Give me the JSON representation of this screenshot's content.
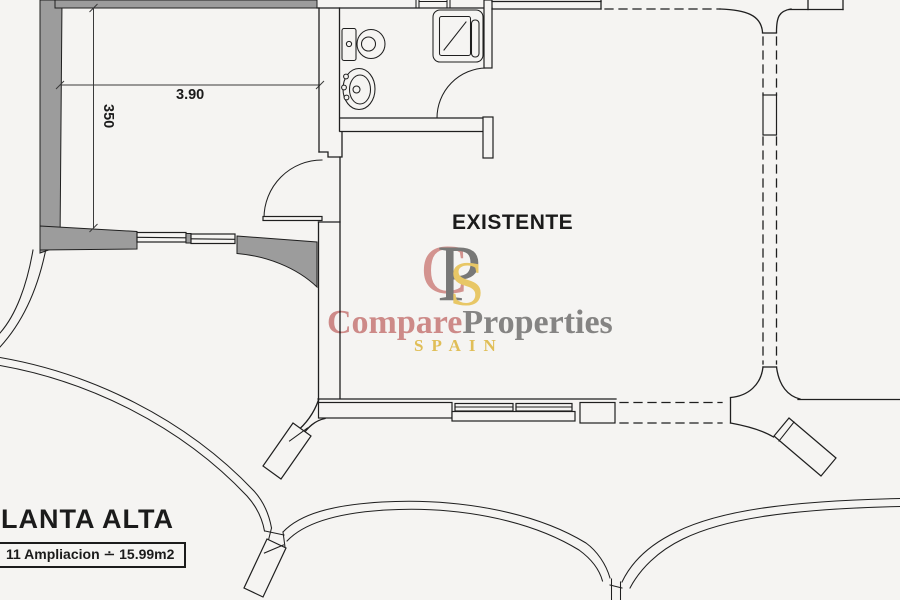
{
  "page": {
    "background": "#f5f4f2"
  },
  "plan": {
    "room_label": "EXISTENTE",
    "title": "PLANTA ALTA",
    "area_note": "11 Ampliacion ∸ 15.99m2",
    "dimensions": {
      "room_width": "3.90",
      "room_depth": "350"
    },
    "colors": {
      "wall_fill": "#9c9c9c",
      "line": "#1f1f1f"
    }
  },
  "watermark": {
    "monogram": [
      "C",
      "P",
      "S"
    ],
    "brand_first": "Compare",
    "brand_second": "Properties",
    "brand_sub": "SPAIN",
    "colors": {
      "first": "#d6908f",
      "second": "#8a8a8a",
      "sub": "#eac75c"
    }
  }
}
